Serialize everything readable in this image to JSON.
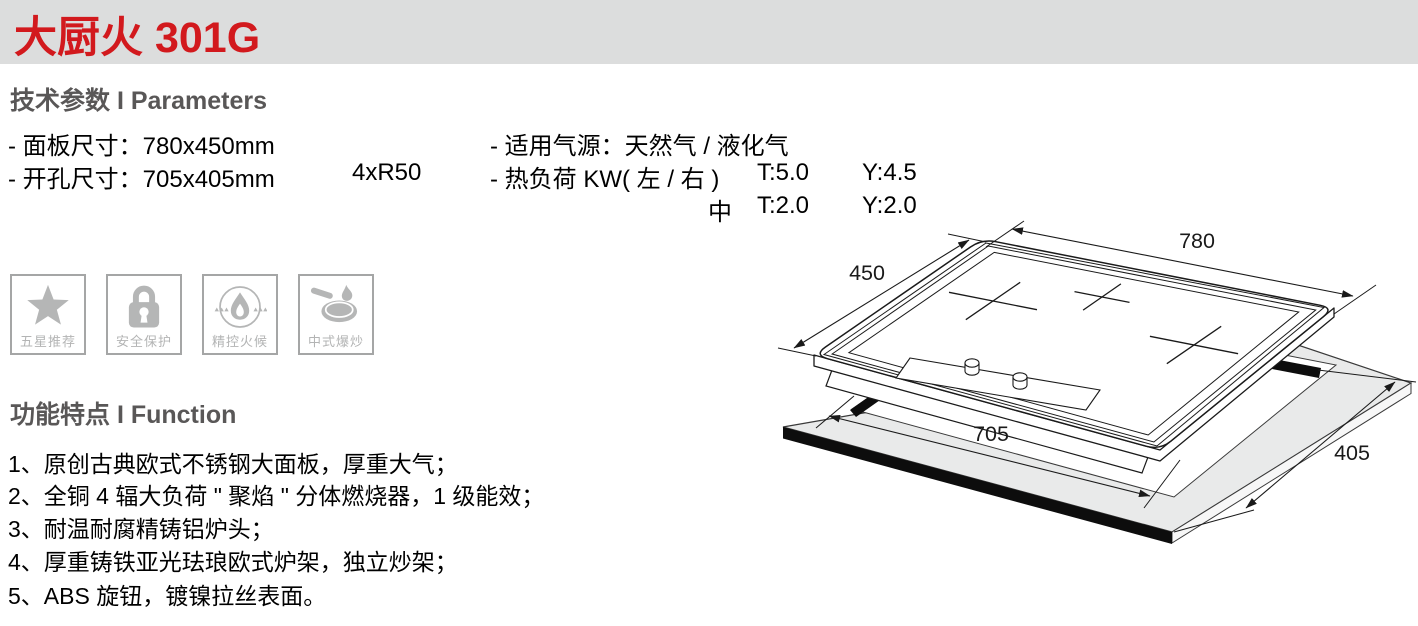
{
  "page": {
    "title": "大厨火 301G"
  },
  "colors": {
    "accent_red": "#d2191d",
    "band_gray": "#dcdddd",
    "heading_gray": "#595757",
    "icon_gray": "#b5b6b6",
    "slab_gray": "#e9eaea",
    "line_black": "#1a1a1a"
  },
  "parameters": {
    "heading": "技术参数 I Parameters",
    "panel_size": "- 面板尺寸：780x450mm",
    "cutout_size": "- 开孔尺寸：705x405mm",
    "corner_radius": "4xR50",
    "gas_source": "- 适用气源：天然气 / 液化气",
    "heat_load": "- 热负荷 KW( 左 / 右 )",
    "lr_t": "T:5.0",
    "lr_y": "Y:4.5",
    "mid_label": "中",
    "mid_t": "T:2.0",
    "mid_y": "Y:2.0"
  },
  "badges": [
    {
      "icon": "star-icon",
      "label": "五星推荐"
    },
    {
      "icon": "lock-icon",
      "label": "安全保护"
    },
    {
      "icon": "flame-icon",
      "label": "精控火候"
    },
    {
      "icon": "wok-icon",
      "label": "中式爆炒"
    }
  ],
  "functions": {
    "heading": "功能特点 I Function",
    "items": [
      "1、原创古典欧式不锈钢大面板，厚重大气；",
      "2、全铜 4 辐大负荷 \" 聚焰 \" 分体燃烧器，1 级能效；",
      "3、耐温耐腐精铸铝炉头；",
      "4、厚重铸铁亚光珐琅欧式炉架，独立炒架；",
      "5、ABS 旋钮，镀镍拉丝表面。"
    ]
  },
  "diagram": {
    "panel_width": "780",
    "panel_depth": "450",
    "cutout_width": "705",
    "cutout_depth": "405"
  }
}
